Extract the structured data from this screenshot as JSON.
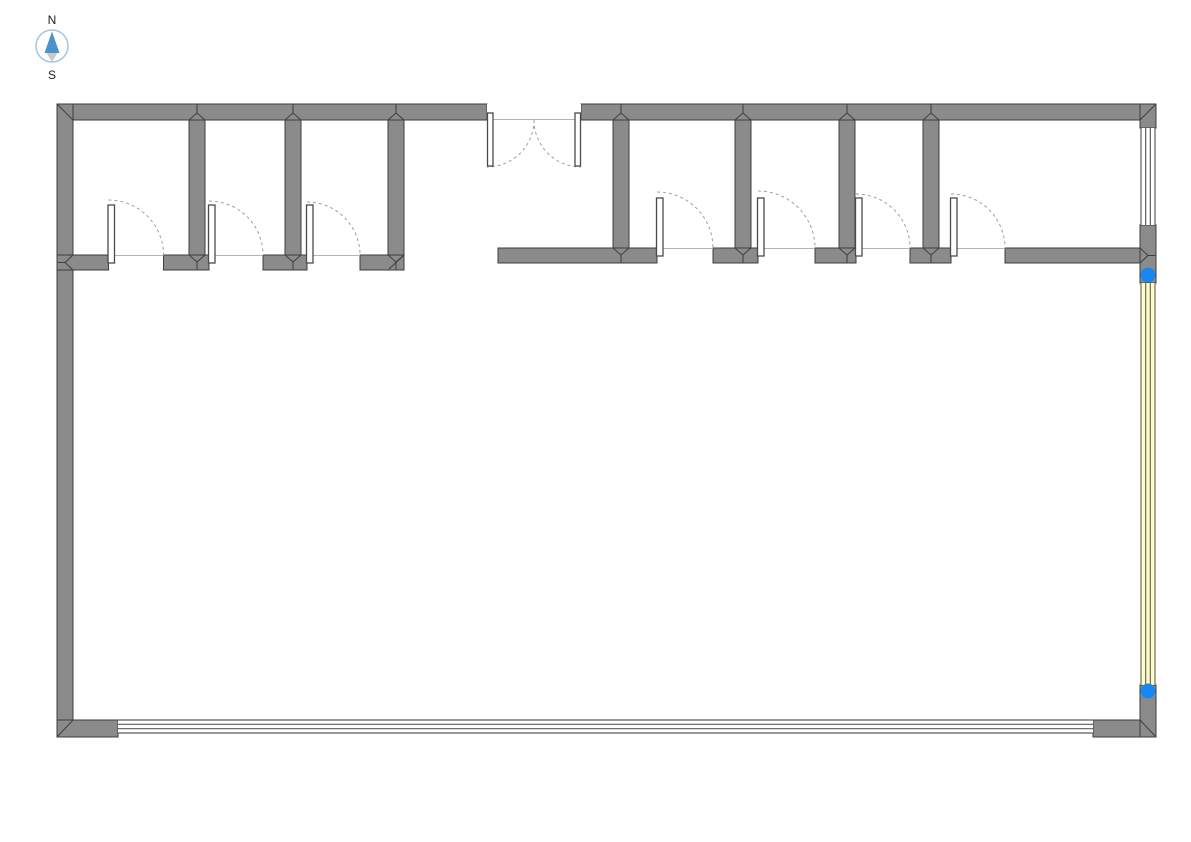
{
  "meta": {
    "width": 1191,
    "height": 842,
    "background": "#ffffff"
  },
  "colors": {
    "wall_fill": "#8b8b8b",
    "wall_stroke": "#3e3e3e",
    "threshold_line": "#b4b4b4",
    "door_leaf_fill": "#ffffff",
    "door_leaf_stroke": "#4a4a4a",
    "door_arc": "#9e9e9e",
    "window_fill": "#ffffff",
    "window_line": "#5c5c5c",
    "highlight_fill": "#fbfbcf",
    "highlight_line": "#6d6d4e",
    "handle_fill": "#1688ef",
    "compass_ring": "#a8c6e2",
    "compass_north": "#4a92cc",
    "compass_south": "#c9c9c9",
    "label_color": "#1c1c1c"
  },
  "compass": {
    "north_label": "N",
    "south_label": "S",
    "cx": 52,
    "cy": 46,
    "r": 16
  },
  "walls": [
    {
      "name": "top-wall-left",
      "x": 57,
      "y": 104,
      "w": 430,
      "h": 16
    },
    {
      "name": "top-wall-right",
      "x": 581,
      "y": 104,
      "w": 575,
      "h": 16
    },
    {
      "name": "left-wall",
      "x": 57,
      "y": 104,
      "w": 16,
      "h": 633
    },
    {
      "name": "interior-wall-1",
      "x": 189,
      "y": 120,
      "w": 16,
      "h": 150
    },
    {
      "name": "interior-wall-2",
      "x": 285,
      "y": 120,
      "w": 16,
      "h": 150
    },
    {
      "name": "interior-wall-3",
      "x": 388,
      "y": 120,
      "w": 16,
      "h": 150
    },
    {
      "name": "south-wall-left-1",
      "x": 57,
      "y": 255,
      "w": 51.5,
      "h": 15
    },
    {
      "name": "south-wall-left-2",
      "x": 163.5,
      "y": 255,
      "w": 45.5,
      "h": 15
    },
    {
      "name": "south-wall-left-3",
      "x": 263,
      "y": 255,
      "w": 44,
      "h": 15
    },
    {
      "name": "south-wall-left-4",
      "x": 360,
      "y": 255,
      "w": 44,
      "h": 15
    },
    {
      "name": "interior-wall-4",
      "x": 613,
      "y": 120,
      "w": 16,
      "h": 143
    },
    {
      "name": "interior-wall-5",
      "x": 735,
      "y": 120,
      "w": 16,
      "h": 143
    },
    {
      "name": "interior-wall-6",
      "x": 839,
      "y": 120,
      "w": 16,
      "h": 143
    },
    {
      "name": "interior-wall-7",
      "x": 923,
      "y": 120,
      "w": 16,
      "h": 143
    },
    {
      "name": "south-wall-right-1",
      "x": 498,
      "y": 248,
      "w": 159,
      "h": 15
    },
    {
      "name": "south-wall-right-2",
      "x": 713,
      "y": 248,
      "w": 45,
      "h": 15
    },
    {
      "name": "south-wall-right-3",
      "x": 815,
      "y": 248,
      "w": 41,
      "h": 15
    },
    {
      "name": "south-wall-right-4",
      "x": 910,
      "y": 248,
      "w": 41,
      "h": 15
    },
    {
      "name": "south-wall-right-5",
      "x": 1005,
      "y": 248,
      "w": 135,
      "h": 15
    },
    {
      "name": "right-wall-top",
      "x": 1140,
      "y": 104,
      "w": 16,
      "h": 24
    },
    {
      "name": "right-wall-mid",
      "x": 1140,
      "y": 225,
      "w": 16,
      "h": 58
    },
    {
      "name": "right-wall-bottom",
      "x": 1140,
      "y": 685,
      "w": 16,
      "h": 52
    },
    {
      "name": "bottom-wall-left-block",
      "x": 57,
      "y": 720,
      "w": 61,
      "h": 17
    },
    {
      "name": "bottom-wall-right-block",
      "x": 1093,
      "y": 720,
      "w": 47,
      "h": 17
    }
  ],
  "windows": [
    {
      "name": "bottom-window",
      "x": 118,
      "y": 720,
      "w": 975,
      "h": 13,
      "orient": "h",
      "style": "plain"
    },
    {
      "name": "right-window-upper",
      "x": 1141,
      "y": 128,
      "w": 14,
      "h": 97,
      "orient": "v",
      "style": "plain"
    },
    {
      "name": "right-window-selected",
      "x": 1141,
      "y": 283,
      "w": 14,
      "h": 402,
      "orient": "v",
      "style": "highlight"
    }
  ],
  "doors": [
    {
      "name": "door-room-1",
      "hinge_x": 108.5,
      "wall_y": 255,
      "width": 55
    },
    {
      "name": "door-room-2",
      "hinge_x": 209,
      "wall_y": 255,
      "width": 54
    },
    {
      "name": "door-room-3",
      "hinge_x": 307,
      "wall_y": 255,
      "width": 53
    },
    {
      "name": "door-room-4",
      "hinge_x": 657,
      "wall_y": 248,
      "width": 56
    },
    {
      "name": "door-room-5",
      "hinge_x": 758,
      "wall_y": 248,
      "width": 57
    },
    {
      "name": "door-room-6",
      "hinge_x": 856,
      "wall_y": 248,
      "width": 54
    },
    {
      "name": "door-room-7",
      "hinge_x": 951,
      "wall_y": 248,
      "width": 54
    }
  ],
  "double_door": {
    "name": "entrance-double-door",
    "x": 487,
    "y": 104,
    "w": 94,
    "h": 16,
    "leaf_len": 53
  },
  "handles": [
    {
      "name": "window-handle-top",
      "cx": 1148,
      "cy": 275,
      "r": 7.5
    },
    {
      "name": "window-handle-bottom",
      "cx": 1148,
      "cy": 691,
      "r": 7.5
    }
  ],
  "miters": [
    [
      57,
      104,
      73,
      120
    ],
    [
      1156,
      104,
      1140,
      120
    ],
    [
      57,
      737,
      73,
      720
    ],
    [
      1140,
      720,
      1156,
      737
    ],
    [
      65,
      262.5,
      73,
      255
    ],
    [
      65,
      262.5,
      73,
      270
    ],
    [
      57,
      262.5,
      65,
      262.5
    ],
    [
      1148,
      255.5,
      1140,
      248
    ],
    [
      1148,
      255.5,
      1140,
      263
    ],
    [
      1148,
      255.5,
      1156,
      255.5
    ],
    [
      389,
      269,
      403,
      256
    ]
  ],
  "junction_marks": [
    {
      "cx": 197,
      "face": 120,
      "apex": 113,
      "back": 104
    },
    {
      "cx": 293,
      "face": 120,
      "apex": 113,
      "back": 104
    },
    {
      "cx": 396,
      "face": 120,
      "apex": 113,
      "back": 104
    },
    {
      "cx": 621,
      "face": 120,
      "apex": 113,
      "back": 104
    },
    {
      "cx": 743,
      "face": 120,
      "apex": 113,
      "back": 104
    },
    {
      "cx": 847,
      "face": 120,
      "apex": 113,
      "back": 104
    },
    {
      "cx": 931,
      "face": 120,
      "apex": 113,
      "back": 104
    },
    {
      "cx": 197,
      "face": 255,
      "apex": 262,
      "back": 270
    },
    {
      "cx": 293,
      "face": 255,
      "apex": 262,
      "back": 270
    },
    {
      "cx": 396,
      "face": 255,
      "apex": 262,
      "back": 270
    },
    {
      "cx": 621,
      "face": 248,
      "apex": 255,
      "back": 263
    },
    {
      "cx": 743,
      "face": 248,
      "apex": 255,
      "back": 263
    },
    {
      "cx": 847,
      "face": 248,
      "apex": 255,
      "back": 263
    },
    {
      "cx": 931,
      "face": 248,
      "apex": 255,
      "back": 263
    }
  ]
}
